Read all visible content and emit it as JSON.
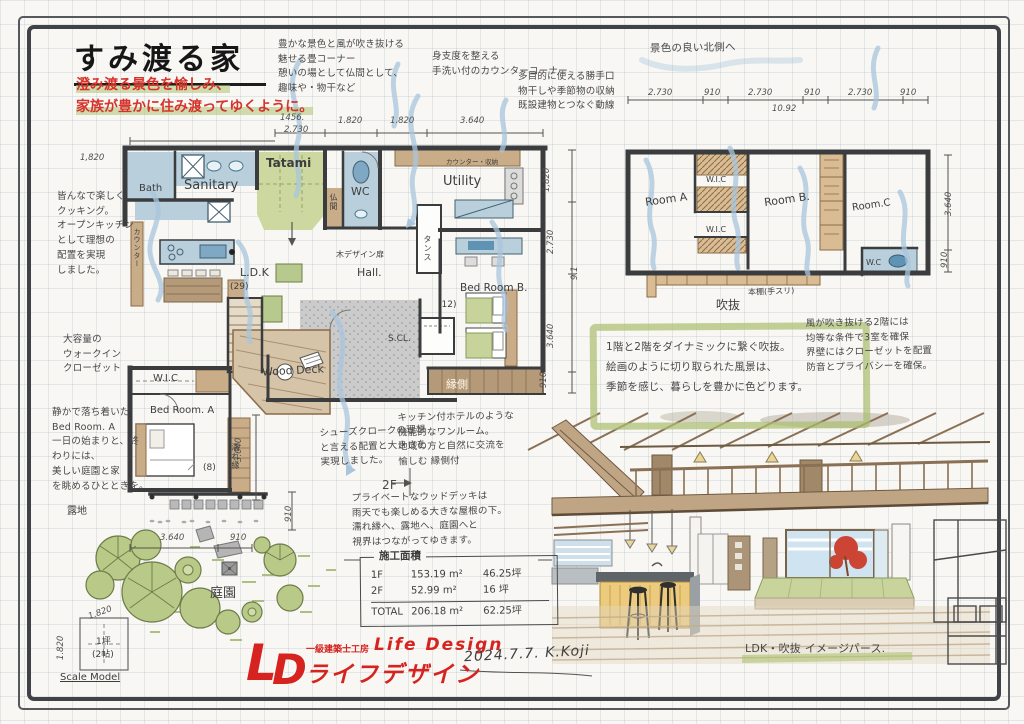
{
  "doc": {
    "title": "すみ渡る家",
    "tagline1": "澄み渡る景色を愉しみ、",
    "tagline2": "家族が豊かに住み渡ってゆくように。"
  },
  "notes": {
    "tatami": "豊かな景色と風が吹き抜ける\n魅せる畳コーナー\n憩いの場として仏間として、\n趣味や・物干など",
    "counter": "身支度を整える\n手洗い付のカウンターコーナー",
    "service": "多目的に使える勝手口\n物干しや季節物の収納\n既設建物とつなぐ動線",
    "north": "景色の良い北側へ",
    "cooking": "皆んなで楽しく\nクッキング。\nオープンキッチン\nとして理想の\n配置を実現\nしました。",
    "wic": "大容量の\nウォークイン\nクローゼット",
    "bedroom_a": "静かで落ち着いた\nBed Room. A\n一日の始まりと、終\nわりには、\n美しい庭園と家\nを眺めるひとときを。",
    "shoes": "シューズクロークの理想\nと言える配置と大きさを\n実現しました。",
    "one_room": "キッチン付ホテルのような\n機能的なワンルーム。\n地域の方と自然に交流を\n愉しむ 縁側付",
    "to_2f": "2F",
    "wood_deck": "プライベートなウッドデッキは\n雨天でも楽しめる大きな屋根の下。\n濡れ縁へ、露地へ、庭園へと\n視界はつながってゆきます。",
    "void_box": "1階と2階をダイナミックに繋ぐ吹抜。\n絵画のように切り取られた風景は、\n季節を感じ、暮らしを豊かに色どります。",
    "second_floor": "風が吹き抜ける2階には\n均等な条件で3室を確保\n界壁にはクローゼットを配置\n防音とプライバシーを確保。",
    "caption": "LDK・吹抜 イメージパース."
  },
  "plan1f": {
    "bath": "Bath",
    "sanitary": "Sanitary",
    "tatami": "Tatami",
    "wc": "WC",
    "butsuma": "仏間",
    "utility": "Utility",
    "counter_storage": "カウンター・収納",
    "counter": "カウンター",
    "hall": "Hall.",
    "ldk": "L.D.K",
    "ldk_size": "(29)",
    "tansu": "タンス",
    "wood_door": "木デザイン扉",
    "bedroom_b": "Bed Room B.",
    "bedroom_b_size": "(12)",
    "scl": "S.CL.",
    "wood_deck": "Wood Deck",
    "engawa": "縁側",
    "bedroom_a": "Bed Room. A",
    "bedroom_a_size": "(8)",
    "wic": "W.I.C",
    "nureen": "濡れ縁",
    "roji": "露地",
    "teien": "庭園"
  },
  "plan2f": {
    "room_a": "Room A",
    "room_b": "Room B.",
    "room_c": "Room.C",
    "wic1": "W.I.C",
    "wic2": "W.I.C",
    "wc": "W.C",
    "fukinuke": "吹抜",
    "bookshelf": "本棚(手スリ)"
  },
  "dims": {
    "f1_left": "1,820",
    "f1_top": [
      "1456.",
      "2.730",
      "1.820",
      "1.820",
      "3.640"
    ],
    "f1_right": [
      "1,820",
      "2.730",
      "9.1",
      "3.640",
      "910"
    ],
    "f2_top": [
      "2.730",
      "910",
      "2.730",
      "910",
      "2.730",
      "910"
    ],
    "f2_total": "10.92",
    "f2_right": [
      "3.640",
      "910"
    ],
    "garden": [
      "3.640",
      "910",
      "910"
    ],
    "deck": "3.640",
    "scale": [
      "1.820",
      "1.820"
    ]
  },
  "area_table": {
    "title": "施工面積",
    "rows": [
      {
        "name": "1F",
        "m2": "153.19 m²",
        "tsubo": "46.25坪"
      },
      {
        "name": "2F",
        "m2": "52.99 m²",
        "tsubo": "16 坪"
      },
      {
        "name": "TOTAL",
        "m2": "206.18 m²",
        "tsubo": "62.25坪"
      }
    ]
  },
  "logo": {
    "monogram_l": "L",
    "monogram_d": "D",
    "firm": "一級建築士工房",
    "en": "Life Design",
    "jp": "ライフデザイン"
  },
  "signature": "2024.7.7.  K.Koji",
  "scale_model": {
    "area": "1坪",
    "mats": "(2帖)",
    "label": "Scale Model"
  }
}
